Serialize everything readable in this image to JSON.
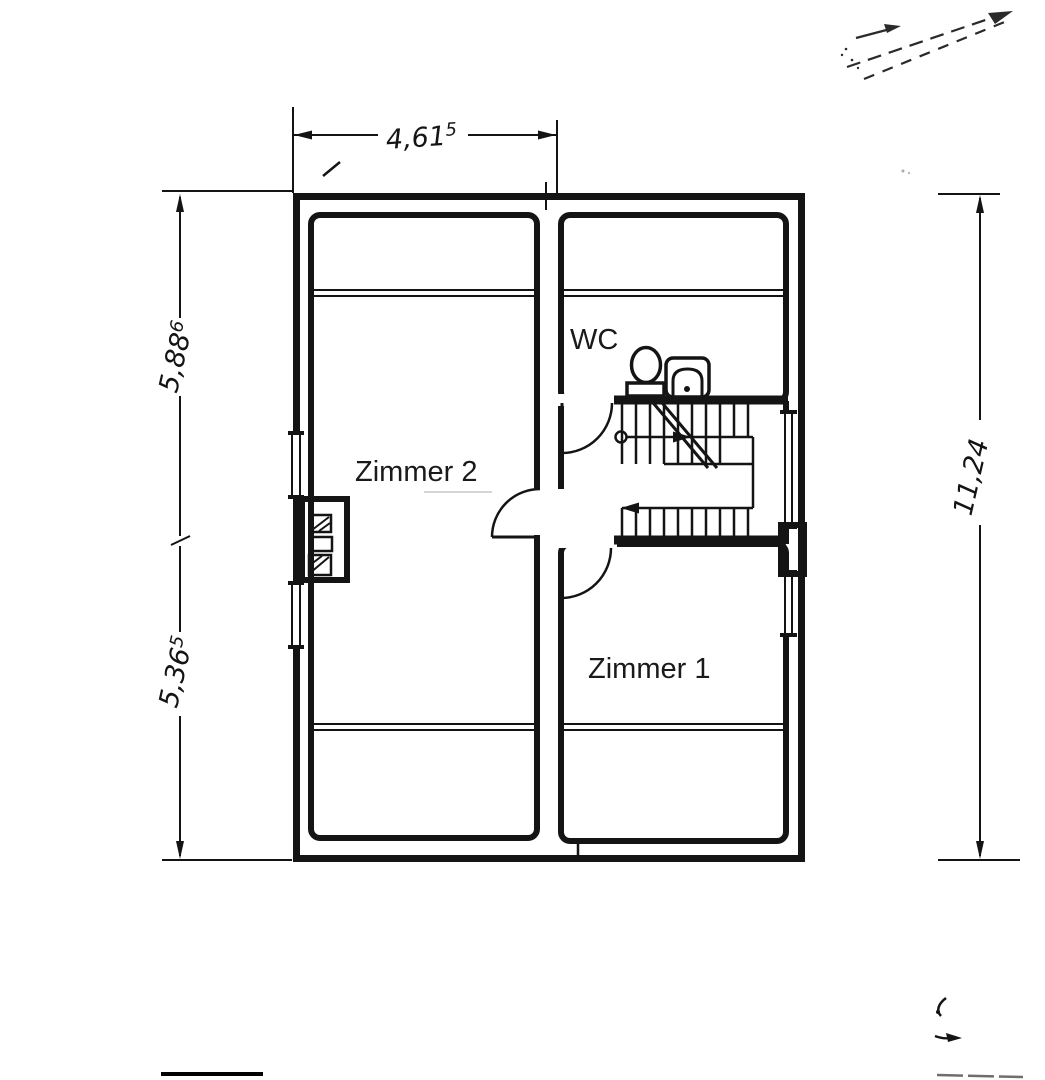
{
  "plan": {
    "type": "floor-plan",
    "room_labels": {
      "zimmer2": "Zimmer 2",
      "zimmer1": "Zimmer 1",
      "wc": "WC"
    },
    "dimensions": {
      "top": {
        "value": "4,61",
        "sup": "5"
      },
      "left_upper": {
        "value": "5,88",
        "sup": "6"
      },
      "left_lower": {
        "value": "5,36",
        "sup": "5"
      },
      "right": {
        "value": "11,24",
        "sup": ""
      }
    },
    "symbols": [
      "toilet-icon",
      "sink-icon",
      "stair-run",
      "door-swing",
      "chimney",
      "window"
    ],
    "colors": {
      "ink": "#141414",
      "paper": "#ffffff",
      "faint": "#555555"
    }
  }
}
